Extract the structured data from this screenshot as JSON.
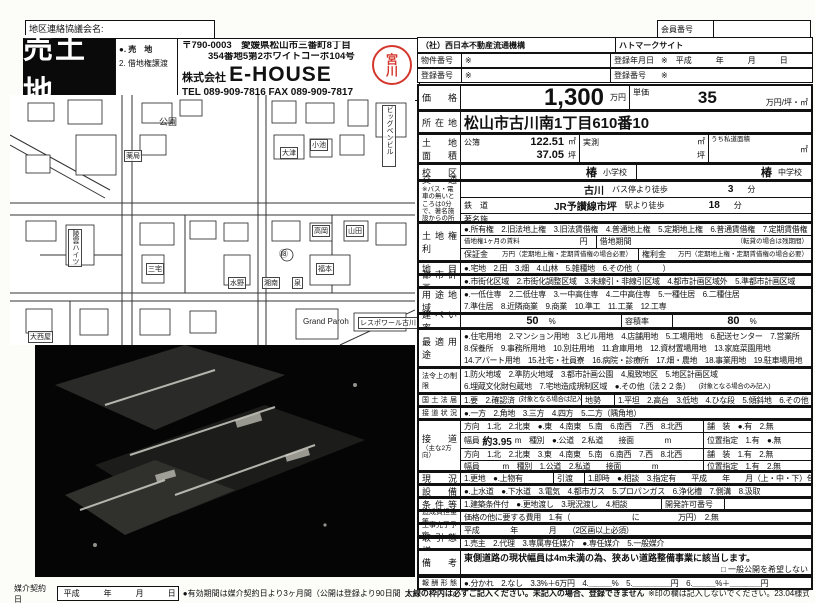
{
  "district_label": "地区連絡協議会名:",
  "banner": {
    "title": "売土地",
    "opt1": "●. 売　地",
    "opt2": "2. 借地権譲渡"
  },
  "company": {
    "postal": "〒790-0003　愛媛県松山市三番町8丁目",
    "address2": "354番地5第2ホワイトコーポ104号",
    "corp_prefix": "株式会社",
    "corp_name": "E-HOUSE",
    "tel": "TEL 089-909-7816 FAX 089-909-7817",
    "stamp": "宮川"
  },
  "map": {
    "park": "公園",
    "pharmacy": "薬局",
    "otsu": "大津",
    "takaoka": "高岡",
    "yamada": "山田",
    "bigben": "ビッグベンビル",
    "miyake": "三宅",
    "fukumoto": "福本",
    "mizuno": "水野",
    "shonan": "湘南",
    "izumi": "泉",
    "grand": "Grand Paroh",
    "lespoir": "レスポワール古川",
    "onishiya": "大西屋",
    "heights": "陵雲ハイツ",
    "koike": "小池",
    "bus18": "⑱"
  },
  "org": {
    "member_label": "会員番号",
    "member_value": "",
    "left_title": "（社）西日本不動産流通機構",
    "right_title": "ハトマークサイト",
    "bukken_label": "物件番号",
    "bukken_value": "※",
    "touroku_date_label": "登録年月日",
    "touroku_date_value": "※　平成　　　年　　　月　　　日",
    "touroku_label": "登録番号",
    "touroku_value": "※",
    "touroku2_label": "登録番号",
    "touroku2_value": "※"
  },
  "price": {
    "label": "価格",
    "value": "1,300",
    "unit": "万円",
    "tanka_label": "単価",
    "tanka": "35",
    "tanka_unit": "万円/坪・㎡"
  },
  "location": {
    "label": "所在地",
    "value": "松山市古川南1丁目610番10"
  },
  "area": {
    "label1": "土地",
    "label2": "面積",
    "koubo_label": "公簿",
    "koubo_m2": "122.51",
    "m2": "㎡",
    "koubo_tsubo": "37.05",
    "tsubo": "坪",
    "jissoku_label": "実測",
    "shidou_label": "うち私道面積"
  },
  "school": {
    "label": "校区",
    "elem": "椿",
    "elem_suffix": "小学校",
    "jhs": "椿",
    "jhs_suffix": "中学校"
  },
  "transport": {
    "label": "交通",
    "note": "※バス・電車の無いところは0分で、著名施設からの所要を記入",
    "bus_name": "古川",
    "bus_suffix": "バス停より徒歩",
    "bus_min": "3",
    "min_unit": "分",
    "rail_label": "鉄　道",
    "rail_name": "JR予讃線市坪",
    "rail_suffix": "駅より徒歩",
    "rail_min": "18",
    "fac_label": "著名施設",
    "fac_suffix": "より",
    "fac_min": ""
  },
  "rights": {
    "label": "土地権利",
    "line1": "●.所有権　2.旧法地上権　3.旧法賃借権　4.普通地上権　5.定期地上権　6.普通賃借権　7.定期賃借権",
    "line2a": "借地権1ヶ月の賃料",
    "line2b": "円",
    "line2c": "借地期間",
    "line2d": "（転貸の場合は残期間）",
    "line3a": "保証金",
    "line3b": "万円（定期地上権・定期賃借権の場合必要）",
    "line3c": "権利金",
    "line3d": "万円（定期地上権・定期賃借権の場合必要）"
  },
  "chimoku": {
    "label": "地目",
    "line": "●.宅地　2.田　3.畑　4.山林　5.雑種地　6.その他（　　　）"
  },
  "toshi": {
    "label": "都市計画",
    "line": "●.市街化区域　2.市街化調整区域　3.未線引・非線引区域　4.都市計画区域外　5.準都市計画区域"
  },
  "yoto": {
    "label": "用途地域",
    "line1": "●.一低住専　2.二低住専　3.一中高住専　4.二中高住専　5.一種住居　6.二種住居",
    "line2": "7.準住居　8.近隣商業　9.商業　10.準工　11.工業　12.工専"
  },
  "kenpei": {
    "label": "建ぺい率",
    "value": "50",
    "pct": "%",
    "yoseki_label": "容積率",
    "yoseki": "80"
  },
  "saiteki": {
    "label": "最適用途",
    "line1": "●.住宅用地　2.マンション用地　3.ビル用地　4.店舗用地　5.工場用地　6.配送センター　7.営業所",
    "line2": "8.保養所　9.事務所用地　10.別荘用地　11.倉庫用地　12.資材置場用地　13.家庭菜園用地",
    "line3": "14.アパート用地　15.社宅・社員寮　16.病院・診療所　17.畑・農地　18.事業用地　19.駐車場用地"
  },
  "horei": {
    "label": "法令上の制限",
    "line1": "1.防火地域　2.準防火地域　3.都市計画公園　4.風致地区　5.地区計画区域",
    "line2": "6.埋蔵文化財包蔵地　7.宅地造成規制区域　●.その他（法２２条）",
    "line2_note": "(対象となる場合のみ記入)"
  },
  "kokudo": {
    "label": "国土法届",
    "left": "1.要　2.確認済",
    "note": "(対象となる場合は記入)",
    "chisei_label": "地勢",
    "right": "1.平坦　2.高台　3.低地　4.ひな段　5.傾斜地　6.その他"
  },
  "setsudo_jokyo": {
    "label": "接道状況",
    "line": "●.一方　2.角地　3.三方　4.四方　5.二方（隅角地）"
  },
  "setsudo": {
    "label": "接　道",
    "sublabel": "（主な2方向）",
    "r1_main": "方向　1.北　2.北東　●.東　4.南東　5.南　6.南西　7.西　8.北西",
    "r1_right": "舗　装　●.有　2.無",
    "r2_pre": "幅員",
    "r2_width": "約3.95",
    "r2_post": "m　種別　●.公道　2.私道　　接面　　　　m",
    "r2_right": "位置指定　1.有　●.無",
    "r3_main": "方向　1.北　2.北東　3.東　4.南東　5.南　6.南西　7.西　8.北西",
    "r3_right": "舗　装　1.有　2.無",
    "r4_main": "幅員　　　m　種別　1.公道　2.私道　　接面　　　　m",
    "r4_right": "位置指定　1.有　2.無"
  },
  "genkyo": {
    "label": "現況",
    "left": "1.更地　●.上物有",
    "mid_label": "引渡",
    "right": "1.即時　●.相談　3.指定有　　平成　　年　　月（上・中・下）旬"
  },
  "setsubi": {
    "label": "設備",
    "line": "●.上水道　●.下水道　3.電気　4.都市ガス　5.プロパンガス　6.浄化槽　7.側溝　8.汲取"
  },
  "joken": {
    "label": "条件等",
    "line": "1.建築条件付　●.更地渡し　3.現況渡し　4.相談",
    "kaihatsu_label": "開発許可番号",
    "kaihatsu_value": ""
  },
  "zosei": {
    "label": "造成負担金等",
    "line": "価格の他に要する費用　1.有（　　　　　　　　に　　　　　万円）　2.無"
  },
  "koji": {
    "label": "工事完了予定",
    "line": "平成　　　　年　　　　月　　（2区画以上必須）"
  },
  "torihiki": {
    "label": "取引態様",
    "line": "1.売主　2.代理　3.専属専任媒介　●.専任媒介　5.一般媒介"
  },
  "biko": {
    "label": "備　考",
    "line": "東側道路の現状幅員は4m未満の為、狭あい道路整備事業に該当します。",
    "checkbox": "□ 一般公開を希望しない"
  },
  "hoshu": {
    "label": "報酬形態",
    "line": "●.分かれ　2.なし　3.3%＋6万円　4.＿＿＿%　5.＿＿＿＿＿円　6.＿＿＿%＋＿＿＿＿円"
  },
  "footer": {
    "baikai_label": "媒介契約日",
    "date_box": "平成　　　年　　　月　　　日",
    "note1": "●有効期間は媒介契約日より3ヶ月間（公開は登録より90日間）",
    "note2": "太線の枠内は必ずご記入ください。未記入の場合、登録できません。",
    "note3": "※印の欄は記入しないでください。",
    "form_code": "23.04様式"
  }
}
